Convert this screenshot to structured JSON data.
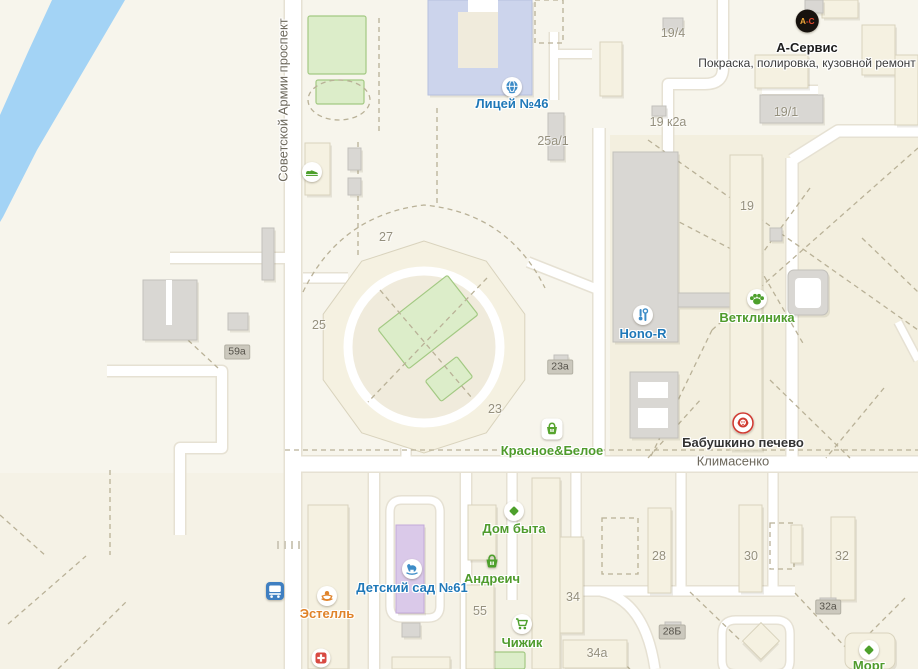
{
  "map": {
    "colors": {
      "water": "#a3d3f5",
      "road": "#ffffff",
      "road_casing": "#e6e1d3",
      "dash": "#b9b197",
      "building": "#f5f1e1",
      "building_stroke": "#d9d3bd",
      "gray_building": "#d9d7d3",
      "gray_stroke": "#c2c0bb",
      "school": "#ccd4ec",
      "school_stroke": "#b6c0de",
      "kindergarten": "#dac9e9",
      "kindergarten_stroke": "#c3a9d9",
      "courtyard": "#f0ebdc",
      "green_fill": "#dcedc9",
      "green_stroke": "#a3c983"
    },
    "streets": [
      {
        "label": "Советской Армии проспект"
      },
      {
        "label": "Климасенко"
      }
    ],
    "business_card": {
      "title": "А-Сервис",
      "subtitle": "Покраска, полировка, кузовной ремонт",
      "icon": "a-service-icon",
      "icon_text": "А-С"
    },
    "pois": [
      {
        "label": "Лицей №46",
        "icon": "globe-icon",
        "color": "#1f78b8",
        "x": 512,
        "y": 87,
        "dy": 9
      },
      {
        "label": "Hono-R",
        "icon": "tools-icon",
        "color": "#1f78b8",
        "x": 643,
        "y": 315,
        "dy": 11
      },
      {
        "label": "Ветклиника",
        "icon": "paw-icon",
        "color": "#4f9b2c",
        "x": 757,
        "y": 299,
        "dy": 11
      },
      {
        "label": "Бабушкино печево",
        "icon": "babushka-icon",
        "color": "#333333",
        "x": 743,
        "y": 423,
        "dy": 12
      },
      {
        "label": "Красное&Белое",
        "icon": "basket-square-icon",
        "color": "#4f9b2c",
        "x": 552,
        "y": 429,
        "dy": 14
      },
      {
        "label": "Дом быта",
        "icon": "diamond-icon",
        "color": "#4f9b2c",
        "x": 514,
        "y": 511,
        "dy": 10
      },
      {
        "label": "Андреич",
        "icon": "basket-icon",
        "color": "#4f9b2c",
        "x": 492,
        "y": 561,
        "dy": 10
      },
      {
        "label": "Детский сад №61",
        "icon": "horse-icon",
        "color": "#1f78b8",
        "x": 412,
        "y": 569,
        "dy": 11
      },
      {
        "label": "Эстелль",
        "icon": "spa-icon",
        "color": "#e0832a",
        "x": 327,
        "y": 596,
        "dy": 10
      },
      {
        "label": "Чижик",
        "icon": "cart-icon",
        "color": "#4f9b2c",
        "x": 522,
        "y": 624,
        "dy": 11
      },
      {
        "label": "Морг",
        "icon": "diamond-icon",
        "color": "#4f9b2c",
        "x": 869,
        "y": 650,
        "dy": 8
      }
    ],
    "markers": [
      {
        "icon": "sneaker-icon",
        "x": 312,
        "y": 172
      },
      {
        "icon": "bus-icon",
        "x": 275,
        "y": 591
      },
      {
        "icon": "pharmacy-icon",
        "x": 321,
        "y": 658
      }
    ],
    "building_numbers": [
      {
        "label": "27",
        "x": 386,
        "y": 237
      },
      {
        "label": "25",
        "x": 319,
        "y": 325
      },
      {
        "label": "23",
        "x": 495,
        "y": 409
      },
      {
        "label": "19",
        "x": 747,
        "y": 206
      },
      {
        "label": "19/4",
        "x": 673,
        "y": 33
      },
      {
        "label": "19 к2а",
        "x": 668,
        "y": 122
      },
      {
        "label": "19/1",
        "x": 786,
        "y": 112
      },
      {
        "label": "25а/1",
        "x": 553,
        "y": 141
      },
      {
        "label": "55",
        "x": 480,
        "y": 611
      },
      {
        "label": "28",
        "x": 659,
        "y": 556
      },
      {
        "label": "30",
        "x": 751,
        "y": 556
      },
      {
        "label": "32",
        "x": 842,
        "y": 556
      },
      {
        "label": "34",
        "x": 573,
        "y": 597
      },
      {
        "label": "34а",
        "x": 597,
        "y": 653
      }
    ],
    "badge_numbers": [
      {
        "label": "59а",
        "x": 237,
        "y": 352
      },
      {
        "label": "23а",
        "x": 560,
        "y": 367
      },
      {
        "label": "28Б",
        "x": 672,
        "y": 632
      },
      {
        "label": "32а",
        "x": 828,
        "y": 607
      }
    ]
  },
  "geometry": {
    "water": "52,0 125,0 37,150 3,217 0,222 0,115 28,52",
    "tints": [
      {
        "x": 610,
        "y": 135,
        "w": 308,
        "h": 329,
        "fill": "#f3efdf"
      },
      {
        "x": 0,
        "y": 473,
        "w": 918,
        "h": 196,
        "fill": "#f5f2e6"
      }
    ],
    "roads": [
      {
        "d": "M 293 0 L 293 669",
        "w": 16
      },
      {
        "d": "M 285 464 L 918 464",
        "w": 15
      },
      {
        "d": "M 599 128 L 599 464",
        "w": 11
      },
      {
        "d": "M 792 158 L 792 464",
        "w": 11
      },
      {
        "d": "M 918 131 L 838 131 L 792 160",
        "w": 11
      },
      {
        "d": "M 723 0 L 723 68 Q 723 84 705 84 L 668 84 L 668 158",
        "w": 10
      },
      {
        "d": "M 762 90 L 818 90",
        "w": 8
      },
      {
        "d": "M 554 32 L 554 100",
        "w": 8
      },
      {
        "d": "M 554 54 L 592 54",
        "w": 8
      },
      {
        "d": "M 170 258 L 285 258",
        "w": 10
      },
      {
        "d": "M 107 371 L 222 371 L 222 448 L 180 448 L 180 535",
        "w": 10
      },
      {
        "d": "M 303 278 L 348 278",
        "w": 9
      },
      {
        "d": "M 406 448 L 406 464",
        "w": 9
      },
      {
        "d": "M 528 262 L 599 290",
        "w": 9
      },
      {
        "d": "M 374 473 L 374 669",
        "w": 10
      },
      {
        "d": "M 466 473 L 466 669",
        "w": 10
      },
      {
        "d": "M 512 473 L 512 600",
        "w": 9
      },
      {
        "d": "M 576 473 L 576 540",
        "w": 9
      },
      {
        "d": "M 681 473 L 681 591",
        "w": 9
      },
      {
        "d": "M 773 473 L 773 591",
        "w": 9
      },
      {
        "d": "M 560 591 L 795 591",
        "w": 9
      },
      {
        "d": "M 600 591 Q 645 600 655 669",
        "w": 9
      },
      {
        "d": "M 390 512 Q 390 500 402 500 L 428 500 Q 440 500 440 512 L 440 606 Q 440 618 428 618 L 402 618 Q 390 618 390 606 Z",
        "w": 7
      },
      {
        "d": "M 722 634 Q 722 620 736 620 L 776 620 Q 790 620 790 634 L 790 660 Q 790 674 776 674 L 736 674 Q 722 674 722 660 Z",
        "w": 7
      },
      {
        "d": "M 898 322 L 918 360",
        "w": 7
      }
    ],
    "ring": {
      "outer": "424,241 361.7,261.2 323.2,314.2 323.2,379.8 361.7,432.8 424,453 486.3,432.8 524.8,379.8 524.8,314.2 486.3,261.2",
      "cx": 424,
      "cy": 347,
      "court_r": 80,
      "road_r": 76
    },
    "greens": [
      {
        "x": 308,
        "y": 16,
        "w": 58,
        "h": 58
      },
      {
        "x": 316,
        "y": 80,
        "w": 48,
        "h": 24
      },
      {
        "x": 470,
        "y": 652,
        "w": 55,
        "h": 17
      },
      {
        "cx": 428,
        "cy": 322,
        "w": 88,
        "h": 50,
        "rot": -38
      },
      {
        "cx": 449,
        "cy": 379,
        "w": 40,
        "h": 26,
        "rot": -38
      }
    ],
    "dashed": [
      "M 285 450 L 918 450",
      "M 648 140 L 918 330",
      "M 918 148 L 712 330",
      "M 712 330 L 650 458",
      "M 810 188 L 756 262 L 804 345",
      "M 862 238 L 918 292",
      "M 756 262 L 660 212",
      "M 770 380 L 850 458",
      "M 884 388 L 826 458",
      "M 648 458 L 702 398",
      "M 303 292 Q 340 215 424 205 Q 508 213 545 288",
      "M 380 290 L 472 398",
      "M 487 278 L 368 402",
      "M 379 18 L 379 135",
      "M 437 108 L 437 205",
      "M 358 142 L 358 256",
      "M 175 328 L 218 368",
      "M 8 624 L 86 556",
      "M 58 669 L 128 600",
      "M 0 515 L 46 556",
      "M 110 470 L 110 555",
      "M 795 593 L 848 650",
      "M 905 598 L 858 645",
      "M 690 592 L 742 642",
      "M 600 643 L 630 669",
      "M 602 518 L 638 518 L 638 574 L 602 574 Z",
      "M 770 523 L 794 523 L 794 569 L 770 569 Z",
      "M 535 0 L 563 0 L 563 43 L 535 43 Z",
      "M 308 100 A 31 20 0 1 0 370 100 A 31 20 0 1 0 308 100"
    ],
    "buildings": [
      {
        "x": 428,
        "y": 0,
        "w": 104,
        "h": 95,
        "t": "school"
      },
      {
        "x": 458,
        "y": 12,
        "w": 40,
        "h": 56,
        "t": "hole"
      },
      {
        "x": 468,
        "y": 0,
        "w": 30,
        "h": 12,
        "t": "white"
      },
      {
        "x": 600,
        "y": 42,
        "w": 22,
        "h": 54,
        "t": "b"
      },
      {
        "x": 755,
        "y": 55,
        "w": 53,
        "h": 33,
        "t": "b"
      },
      {
        "x": 822,
        "y": 0,
        "w": 36,
        "h": 18,
        "t": "b"
      },
      {
        "x": 862,
        "y": 25,
        "w": 33,
        "h": 50,
        "t": "b"
      },
      {
        "x": 895,
        "y": 55,
        "w": 23,
        "h": 70,
        "t": "b"
      },
      {
        "x": 805,
        "y": 0,
        "w": 18,
        "h": 13,
        "t": "g"
      },
      {
        "x": 760,
        "y": 95,
        "w": 63,
        "h": 28,
        "t": "g"
      },
      {
        "x": 663,
        "y": 18,
        "w": 20,
        "h": 13,
        "t": "g"
      },
      {
        "x": 652,
        "y": 106,
        "w": 14,
        "h": 10,
        "t": "g"
      },
      {
        "x": 548,
        "y": 113,
        "w": 16,
        "h": 47,
        "t": "g"
      },
      {
        "x": 305,
        "y": 143,
        "w": 25,
        "h": 52,
        "t": "b"
      },
      {
        "x": 348,
        "y": 148,
        "w": 13,
        "h": 22,
        "t": "g"
      },
      {
        "x": 348,
        "y": 178,
        "w": 13,
        "h": 17,
        "t": "g"
      },
      {
        "x": 262,
        "y": 228,
        "w": 12,
        "h": 52,
        "t": "g"
      },
      {
        "x": 143,
        "y": 280,
        "w": 54,
        "h": 60,
        "t": "g"
      },
      {
        "x": 166,
        "y": 280,
        "w": 6,
        "h": 45,
        "t": "white"
      },
      {
        "x": 228,
        "y": 313,
        "w": 20,
        "h": 17,
        "t": "g"
      },
      {
        "x": 613,
        "y": 152,
        "w": 65,
        "h": 190,
        "t": "g"
      },
      {
        "x": 678,
        "y": 293,
        "w": 52,
        "h": 14,
        "t": "g"
      },
      {
        "x": 730,
        "y": 155,
        "w": 32,
        "h": 295,
        "t": "b"
      },
      {
        "x": 770,
        "y": 228,
        "w": 12,
        "h": 13,
        "t": "g"
      },
      {
        "x": 788,
        "y": 270,
        "w": 40,
        "h": 45,
        "t": "g",
        "rx": 6
      },
      {
        "x": 795,
        "y": 278,
        "w": 26,
        "h": 30,
        "t": "white",
        "rx": 4
      },
      {
        "x": 630,
        "y": 372,
        "w": 48,
        "h": 66,
        "t": "g"
      },
      {
        "x": 638,
        "y": 382,
        "w": 30,
        "h": 16,
        "t": "white"
      },
      {
        "x": 638,
        "y": 408,
        "w": 30,
        "h": 20,
        "t": "white"
      },
      {
        "x": 554,
        "y": 355,
        "w": 14,
        "h": 10,
        "t": "g"
      },
      {
        "x": 308,
        "y": 505,
        "w": 40,
        "h": 164,
        "t": "b"
      },
      {
        "x": 396,
        "y": 525,
        "w": 28,
        "h": 88,
        "t": "kg"
      },
      {
        "x": 402,
        "y": 623,
        "w": 18,
        "h": 14,
        "t": "g"
      },
      {
        "x": 392,
        "y": 657,
        "w": 58,
        "h": 12,
        "t": "b"
      },
      {
        "x": 468,
        "y": 505,
        "w": 28,
        "h": 55,
        "t": "b"
      },
      {
        "x": 466,
        "y": 585,
        "w": 28,
        "h": 84,
        "t": "b"
      },
      {
        "x": 532,
        "y": 478,
        "w": 28,
        "h": 191,
        "t": "b"
      },
      {
        "x": 560,
        "y": 537,
        "w": 23,
        "h": 96,
        "t": "b"
      },
      {
        "x": 563,
        "y": 640,
        "w": 64,
        "h": 28,
        "t": "b"
      },
      {
        "x": 648,
        "y": 508,
        "w": 23,
        "h": 85,
        "t": "b"
      },
      {
        "x": 739,
        "y": 505,
        "w": 23,
        "h": 87,
        "t": "b"
      },
      {
        "x": 791,
        "y": 525,
        "w": 11,
        "h": 38,
        "t": "b"
      },
      {
        "x": 831,
        "y": 517,
        "w": 24,
        "h": 83,
        "t": "b"
      },
      {
        "x": 845,
        "y": 633,
        "w": 50,
        "h": 36,
        "t": "b",
        "rx": 8
      },
      {
        "x": 748,
        "y": 628,
        "w": 26,
        "h": 26,
        "t": "b",
        "rot": 45
      },
      {
        "x": 665,
        "y": 622,
        "w": 16,
        "h": 8,
        "t": "g"
      },
      {
        "x": 820,
        "y": 598,
        "w": 16,
        "h": 8,
        "t": "g"
      }
    ],
    "marks": [
      "M 278 541 L 278 549",
      "M 285 541 L 285 549",
      "M 292 541 L 292 549",
      "M 299 541 L 299 549"
    ]
  }
}
